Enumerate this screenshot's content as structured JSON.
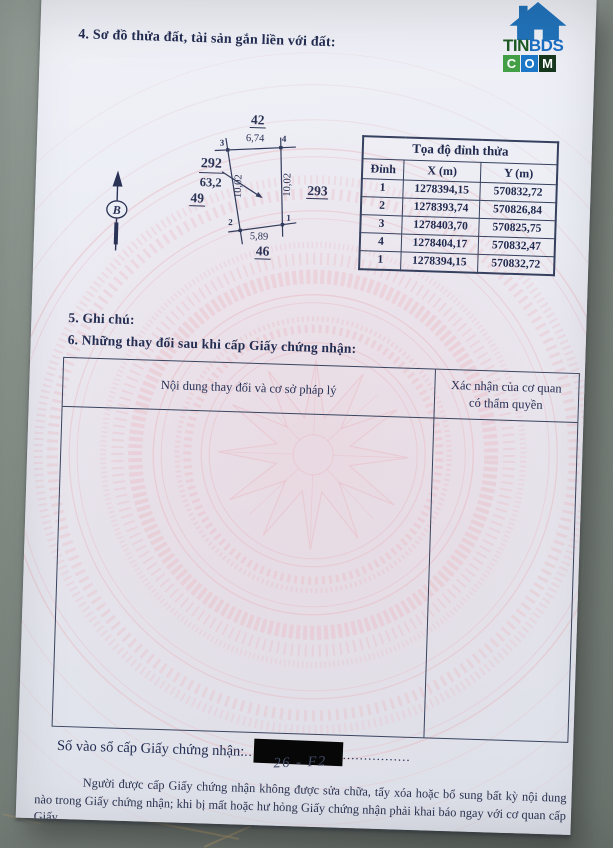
{
  "branding": {
    "site_part1": "TIN",
    "site_part2": "BDS",
    "site_line2_letters": [
      "C",
      "O",
      "M"
    ]
  },
  "page": {
    "section4_title": "4. Sơ đồ thửa đất, tài sản gắn liền với đất:",
    "section5_title": "5. Ghi chú:",
    "section6_title": "6. Những thay đổi sau khi cấp Giấy chứng nhận:",
    "north_symbol": "B",
    "diagram": {
      "adjacent_top": "42",
      "adjacent_left": "49",
      "adjacent_right": "293",
      "adjacent_bottom": "46",
      "plot_number": "292",
      "area": "63,2",
      "edge_top": "6,74",
      "edge_bottom": "5,89",
      "edge_left": "10,02",
      "edge_right": "10,02",
      "vertex_1": "1",
      "vertex_2": "2",
      "vertex_3": "3",
      "vertex_4": "4"
    },
    "coord_table": {
      "title": "Tọa độ đỉnh thửa",
      "headers": [
        "Đỉnh",
        "X (m)",
        "Y (m)"
      ],
      "rows": [
        [
          "1",
          "1278394,15",
          "570832,72"
        ],
        [
          "2",
          "1278393,74",
          "570826,84"
        ],
        [
          "3",
          "1278403,70",
          "570825,75"
        ],
        [
          "4",
          "1278404,17",
          "570832,47"
        ],
        [
          "1",
          "1278394,15",
          "570832,72"
        ]
      ]
    },
    "changes_table": {
      "col1_header": "Nội dung thay đổi và cơ sở pháp lý",
      "col2_header": "Xác nhận của cơ quan có thẩm quyền"
    },
    "issue_label": "Số vào sổ cấp Giấy chứng nhận:",
    "issue_dots_before": "..",
    "issue_dots_after": "................",
    "handwritten_number": "26 - F2",
    "footer_note": "Người được cấp Giấy chứng nhận không được sửa chữa, tẩy xóa hoặc bổ sung bất kỳ nội dung nào trong Giấy chứng nhận; khi bị mất hoặc hư hỏng Giấy chứng nhận phải khai báo ngay với cơ quan cấp Giấy."
  },
  "colors": {
    "ink_navy": "#232d52",
    "table_border": "#36415f",
    "pattern_pink": "#eab9c2",
    "paper_tint": "#e9ecf4",
    "floor_gray": "#8d968f",
    "grout_tan": "#b9a77f",
    "redaction": "#070707",
    "logo_green_dark": "#1e5c24",
    "logo_blue": "#1a6fc4",
    "logo_box_green": "#43a047",
    "logo_box_blue": "#1e78c8",
    "logo_box_dark": "#17371f"
  }
}
